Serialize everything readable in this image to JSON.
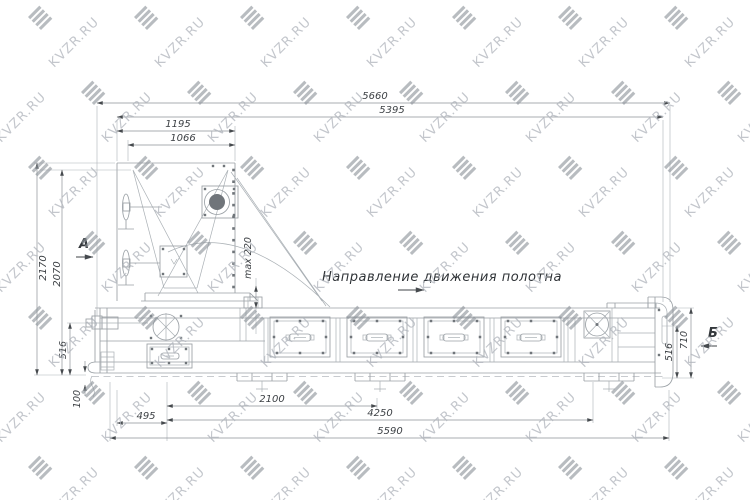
{
  "watermark": {
    "text": "KVZR.RU",
    "logo": "kvzr-stripes-logo"
  },
  "annotations": {
    "direction_label": "Направление движения полотна",
    "view_marker_a": "А",
    "view_marker_b": "Б"
  },
  "dimensions": {
    "top": {
      "overall": "5660",
      "secondary": "5395",
      "head_width": "1195",
      "hopper_width": "1066"
    },
    "left": {
      "overall_height": "2170",
      "body_height": "2070",
      "belt_height": "516",
      "base_offset": "100"
    },
    "center": {
      "max_gap": "max 220"
    },
    "right": {
      "end_height": "710",
      "belt_height": "516"
    },
    "bottom": {
      "left_offset": "495",
      "panel_span": "2100",
      "frame_span": "4250",
      "base_length": "5590"
    }
  },
  "colors": {
    "machine_line": "#9aa0a5",
    "dimension_line": "#8d9298",
    "text": "#3d4145",
    "watermark_text": "#afb4bb",
    "watermark_logo": "#8d939a"
  }
}
